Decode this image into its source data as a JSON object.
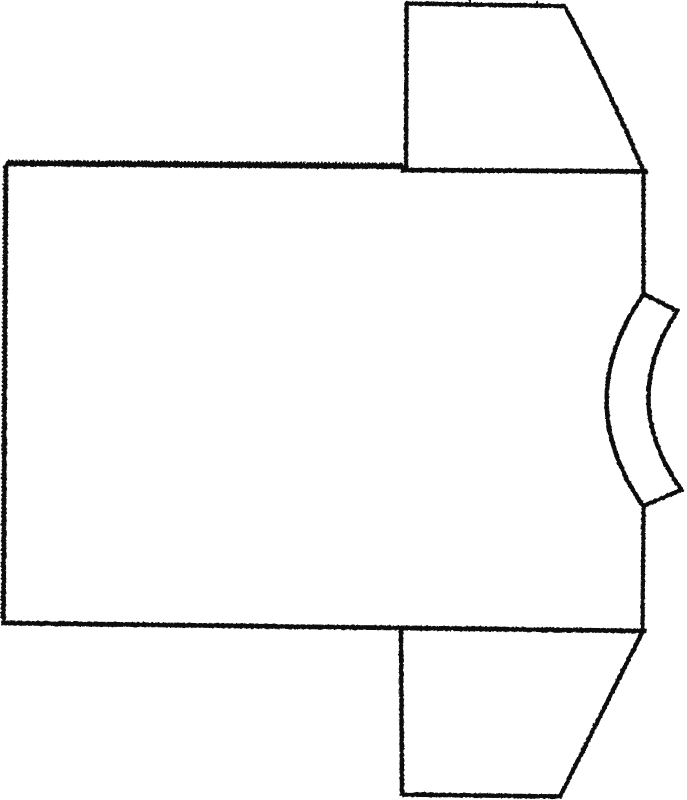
{
  "canvas": {
    "width": 687,
    "height": 800,
    "background": "#ffffff",
    "ink": "#0b0b0b"
  },
  "figure": {
    "description": "Line drawing of a T-shirt sewing pattern shown rotated sideways: large rectangular body panel at left with pinked hem edge, two trapezoidal sleeves on the right (top and bottom), and a curved neckband strip at the middle of the right edge",
    "shapes": [
      {
        "name": "body-hem-edge-pinked",
        "type": "pinked-line",
        "x1": 7,
        "y1": 164.5,
        "x2": 404,
        "y2": 167.5,
        "spacing": 3.6,
        "height": 3.2,
        "flip": true,
        "stroke_width": 3.4
      },
      {
        "name": "body-left-edge-pinked",
        "type": "pinked-line",
        "x1": 6.5,
        "y1": 165.5,
        "x2": 4,
        "y2": 622.5,
        "spacing": 4.2,
        "height": 1.8,
        "flip": false,
        "stroke_width": 3.6
      },
      {
        "name": "body-shoulder-edge",
        "type": "line",
        "x1": 403,
        "y1": 170,
        "x2": 645.5,
        "y2": 171.5,
        "stroke_width": 4.8
      },
      {
        "name": "body-side-edge-upper",
        "type": "line",
        "x1": 643.5,
        "y1": 171,
        "x2": 643.5,
        "y2": 294,
        "stroke_width": 4.2
      },
      {
        "name": "body-side-edge-lower",
        "type": "line",
        "x1": 643.5,
        "y1": 506,
        "x2": 642.5,
        "y2": 630,
        "stroke_width": 4.2
      },
      {
        "name": "body-bottom-edge",
        "type": "line",
        "x1": 3.5,
        "y1": 623,
        "x2": 644,
        "y2": 631,
        "stroke_width": 4.8
      },
      {
        "name": "top-sleeve-outline",
        "type": "path",
        "d": "M 406 170 L 406.5 3.5 L 564.5 6 Q 608 86 643.5 171",
        "fill": "none",
        "stroke_width": 4.4
      },
      {
        "name": "top-sleeve-notch-1",
        "type": "line",
        "x1": 470,
        "y1": 1,
        "x2": 470,
        "y2": 6.5,
        "stroke_width": 2
      },
      {
        "name": "top-sleeve-notch-2",
        "type": "line",
        "x1": 537,
        "y1": 2,
        "x2": 537,
        "y2": 7,
        "stroke_width": 2
      },
      {
        "name": "bottom-sleeve-outline",
        "type": "path",
        "d": "M 401 628 L 402 794.5 L 560 796.5 L 642.5 631.5",
        "fill": "none",
        "stroke_width": 4.4
      },
      {
        "name": "neckband-strip",
        "type": "path",
        "d": "M 643.5 294 Q 570 400 643 506 L 681.5 490 Q 617.5 400 677.5 311 Z",
        "fill": "#ffffff",
        "stroke_width": 4.4,
        "rough": true
      }
    ]
  }
}
